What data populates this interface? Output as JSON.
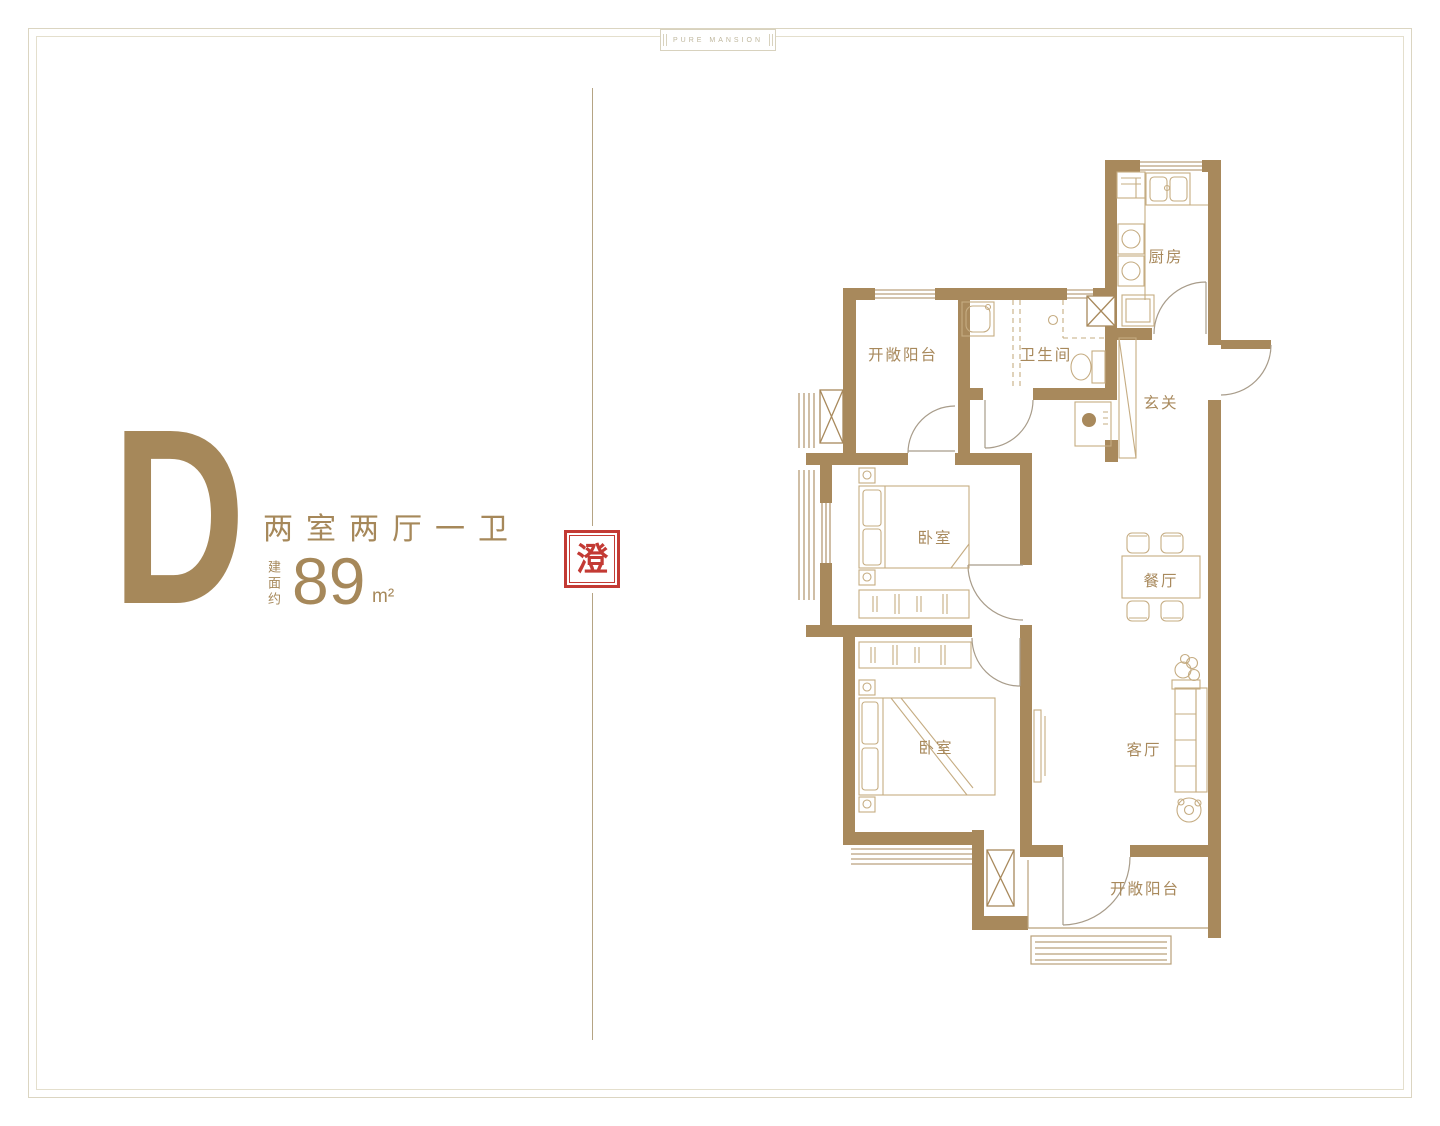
{
  "page": {
    "badge_text": "PURE MANSION"
  },
  "unit": {
    "letter": "D",
    "layout": "两室两厅一卫",
    "area_prefix": "建面约",
    "area_value": "89",
    "area_unit": "m²",
    "seal_char": "澄"
  },
  "plan": {
    "rooms": [
      {
        "id": "kitchen",
        "label": "厨房"
      },
      {
        "id": "balcony-top",
        "label": "开敞阳台"
      },
      {
        "id": "bathroom",
        "label": "卫生间"
      },
      {
        "id": "foyer",
        "label": "玄关"
      },
      {
        "id": "bedroom-1",
        "label": "卧室"
      },
      {
        "id": "dining",
        "label": "餐厅"
      },
      {
        "id": "bedroom-2",
        "label": "卧室"
      },
      {
        "id": "living",
        "label": "客厅"
      },
      {
        "id": "balcony-bottom",
        "label": "开敞阳台"
      }
    ]
  },
  "colors": {
    "wall": "#A8895C",
    "furniture": "#C5AC82",
    "door": "#A89C8A",
    "label": "#A8895C",
    "accent": "#A6885A",
    "seal": "#C33A34",
    "frame": "#DBD5C1"
  }
}
